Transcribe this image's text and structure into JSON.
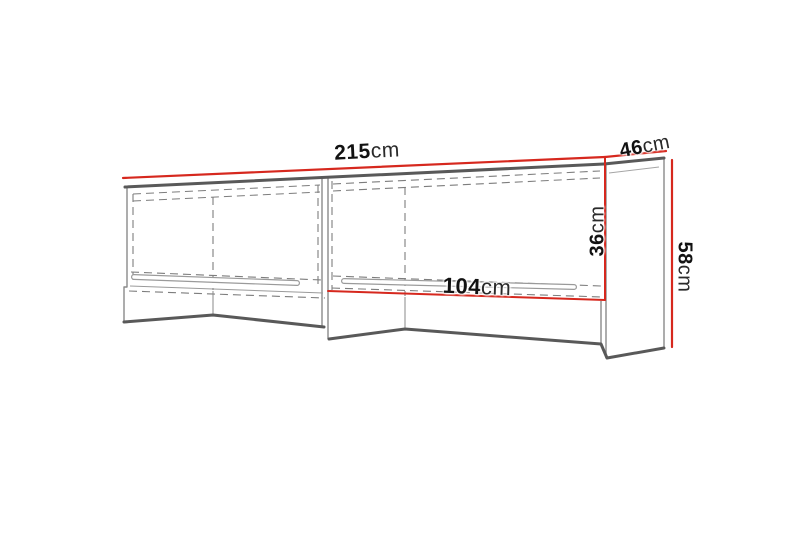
{
  "diagram": {
    "colors": {
      "dimension_line": "#d6281e",
      "outline_dark": "#595959",
      "outline_light": "#8a8a8a",
      "hidden_edge": "#7d7d7d",
      "label_text": "#121212"
    },
    "dimensions": {
      "total_width": {
        "value": "215",
        "unit": "cm"
      },
      "depth": {
        "value": "46",
        "unit": "cm"
      },
      "side_height": {
        "value": "58",
        "unit": "cm"
      },
      "opening_height": {
        "value": "36",
        "unit": "cm"
      },
      "opening_width": {
        "value": "104",
        "unit": "cm"
      }
    }
  }
}
